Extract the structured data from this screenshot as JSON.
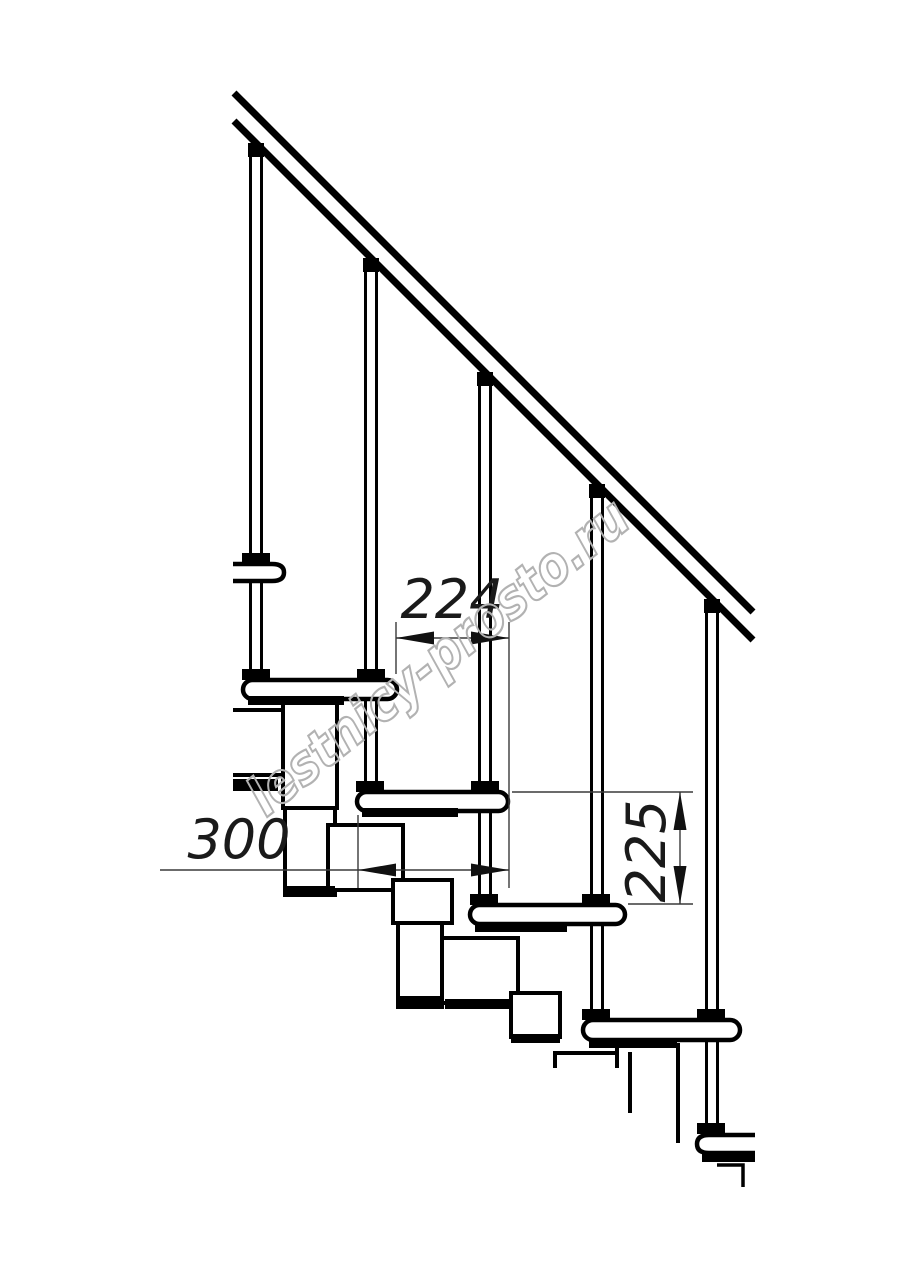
{
  "drawing": {
    "type": "modular-staircase-side-view",
    "watermark": {
      "text": "lestnicy-prosto.ru",
      "color": "#b2b2b2"
    },
    "dimensions": {
      "step_run": {
        "value": "224"
      },
      "tread_depth": {
        "value": "300"
      },
      "step_rise": {
        "value": "225"
      }
    },
    "colors": {
      "background": "#ffffff",
      "line": "#000000",
      "dim_line": "#3a3a3a",
      "arrow": "#111111"
    }
  }
}
